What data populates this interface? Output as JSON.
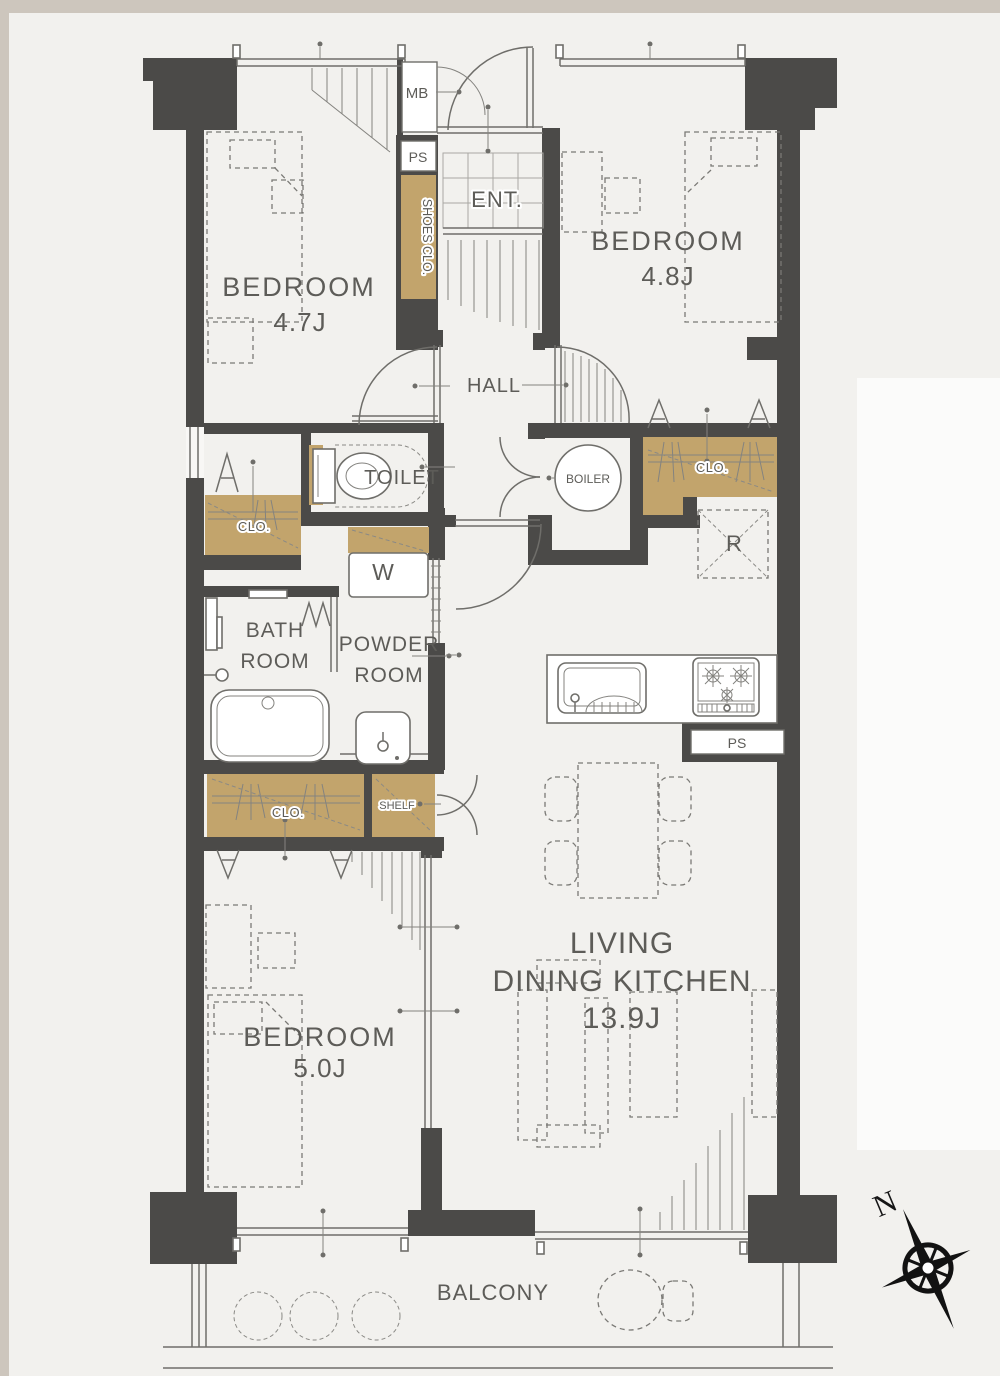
{
  "rooms": {
    "bedroom_top_left": {
      "name": "BEDROOM",
      "size": "4.7J"
    },
    "bedroom_top_right": {
      "name": "BEDROOM",
      "size": "4.8J"
    },
    "bedroom_bottom": {
      "name": "BEDROOM",
      "size": "5.0J"
    },
    "living": {
      "name_line1": "LIVING",
      "name_line2": "DINING KITCHEN",
      "size": "13.9J"
    },
    "hall": {
      "name": "HALL"
    },
    "entrance": {
      "name": "ENT."
    },
    "toilet": {
      "name": "TOILET"
    },
    "boiler": {
      "name": "BOILER"
    },
    "bathroom": {
      "name_line1": "BATH",
      "name_line2": "ROOM"
    },
    "powder": {
      "name_line1": "POWDER",
      "name_line2": "ROOM"
    },
    "balcony": {
      "name": "BALCONY"
    }
  },
  "features": {
    "mail_box": "MB",
    "pipe_shaft_top": "PS",
    "pipe_shaft_kitchen": "PS",
    "shoes_closet": "SHOES CLO.",
    "closet_hall": "CLO.",
    "closet_bedroom_top_left": "CLO.",
    "closet_bedroom_bottom": "CLO.",
    "shelf": "SHELF",
    "washing_machine": "W",
    "refrigerator": "R"
  },
  "compass": {
    "north_label": "N"
  },
  "colors": {
    "wall": "#4b4a48",
    "closet_fill": "#c2a46c",
    "page_background": "#f2f1ee",
    "margin": "#cdc6bd",
    "line": "#6f6e6a",
    "text": "#5d5c58"
  }
}
